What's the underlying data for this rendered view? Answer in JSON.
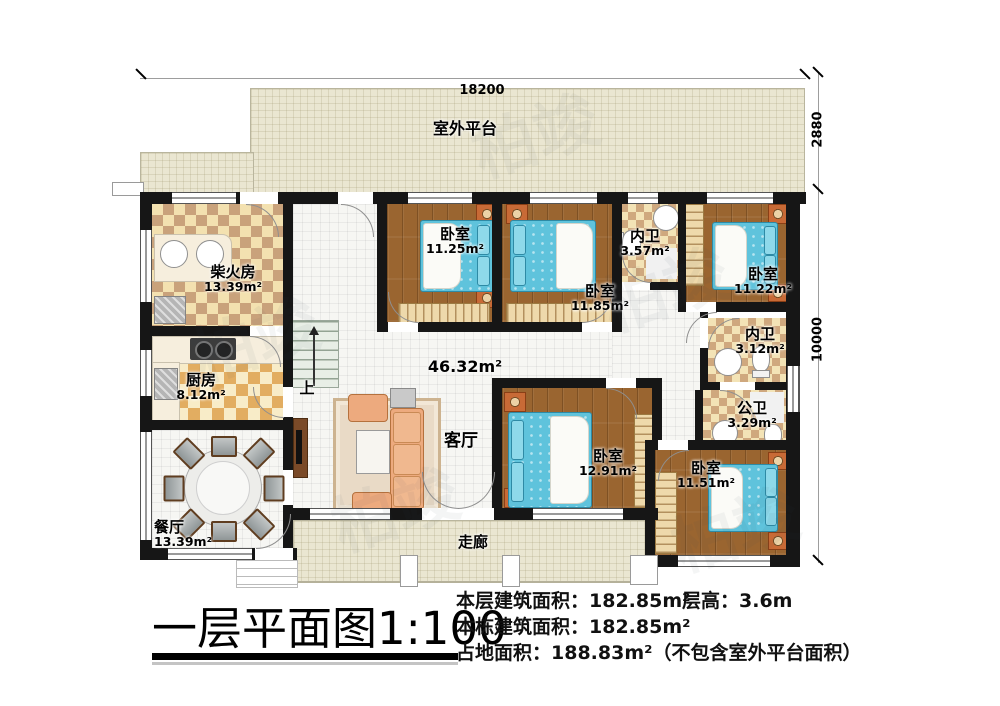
{
  "watermark": "柏竣",
  "dimensions": {
    "top_width": "18200",
    "platform_depth": "2880",
    "house_depth": "10000"
  },
  "rooms": {
    "platform": {
      "label": "室外平台"
    },
    "chaihuofang": {
      "label": "柴火房",
      "area": "13.39m²"
    },
    "kitchen": {
      "label": "厨房",
      "area": "8.12m²"
    },
    "dining": {
      "label": "餐厅",
      "area": "13.39m²"
    },
    "living": {
      "label": "客厅",
      "area": "46.32m²"
    },
    "br1125": {
      "label": "卧室",
      "area": "11.25m²"
    },
    "br1185": {
      "label": "卧室",
      "area": "11.85m²"
    },
    "bath357": {
      "label": "内卫",
      "area": "3.57m²"
    },
    "br1122": {
      "label": "卧室",
      "area": "11.22m²"
    },
    "bath312": {
      "label": "内卫",
      "area": "3.12m²"
    },
    "bath329": {
      "label": "公卫",
      "area": "3.29m²"
    },
    "br1291": {
      "label": "卧室",
      "area": "12.91m²"
    },
    "br1151": {
      "label": "卧室",
      "area": "11.51m²"
    },
    "corridor": {
      "label": "走廊"
    },
    "stairs": {
      "label": "上"
    }
  },
  "title": {
    "main": "一层平面图",
    "scale": "1:100"
  },
  "stats": {
    "line1": "本层建筑面积：182.85m²",
    "height": "层高：3.6m",
    "line2": "本栋建筑面积：182.85m²",
    "line3": "占地面积：188.83m²（不包含室外平台面积）"
  }
}
